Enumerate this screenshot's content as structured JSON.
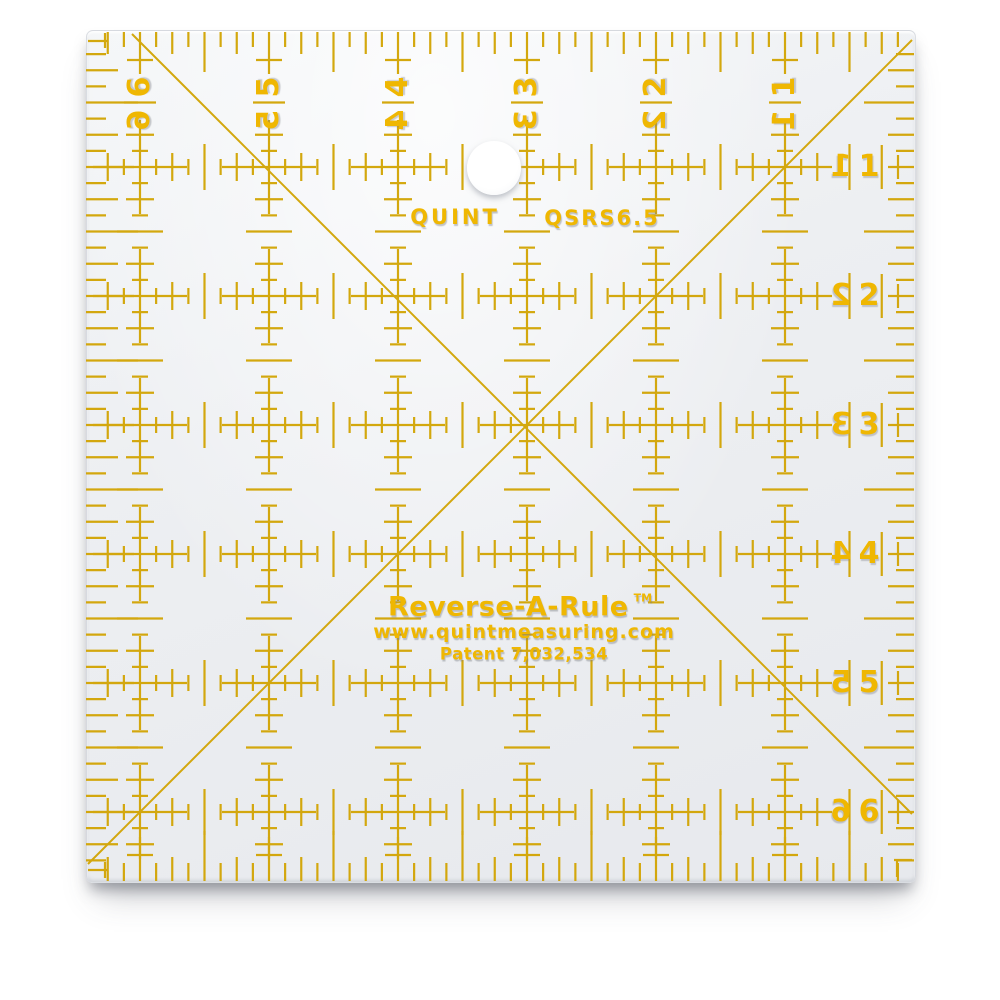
{
  "product": {
    "brand": "QUINT",
    "model": "QSRS6.5",
    "name": "Reverse-A-Rule",
    "trademark": "TM",
    "website": "www.quintmeasuring.com",
    "patent": "Patent 7,032,534"
  },
  "scales": {
    "top_numbers": [
      "6",
      "5",
      "4",
      "3",
      "2",
      "1"
    ],
    "right_numbers": [
      "1",
      "2",
      "3",
      "4",
      "5",
      "6"
    ]
  },
  "colors": {
    "marking": "#d2a402",
    "digits": "#efb702",
    "body_light": "#f4f6f8",
    "body_dark": "#e7e9ed",
    "background": "#ffffff",
    "shadow": "rgba(75,80,92,0.5)"
  }
}
